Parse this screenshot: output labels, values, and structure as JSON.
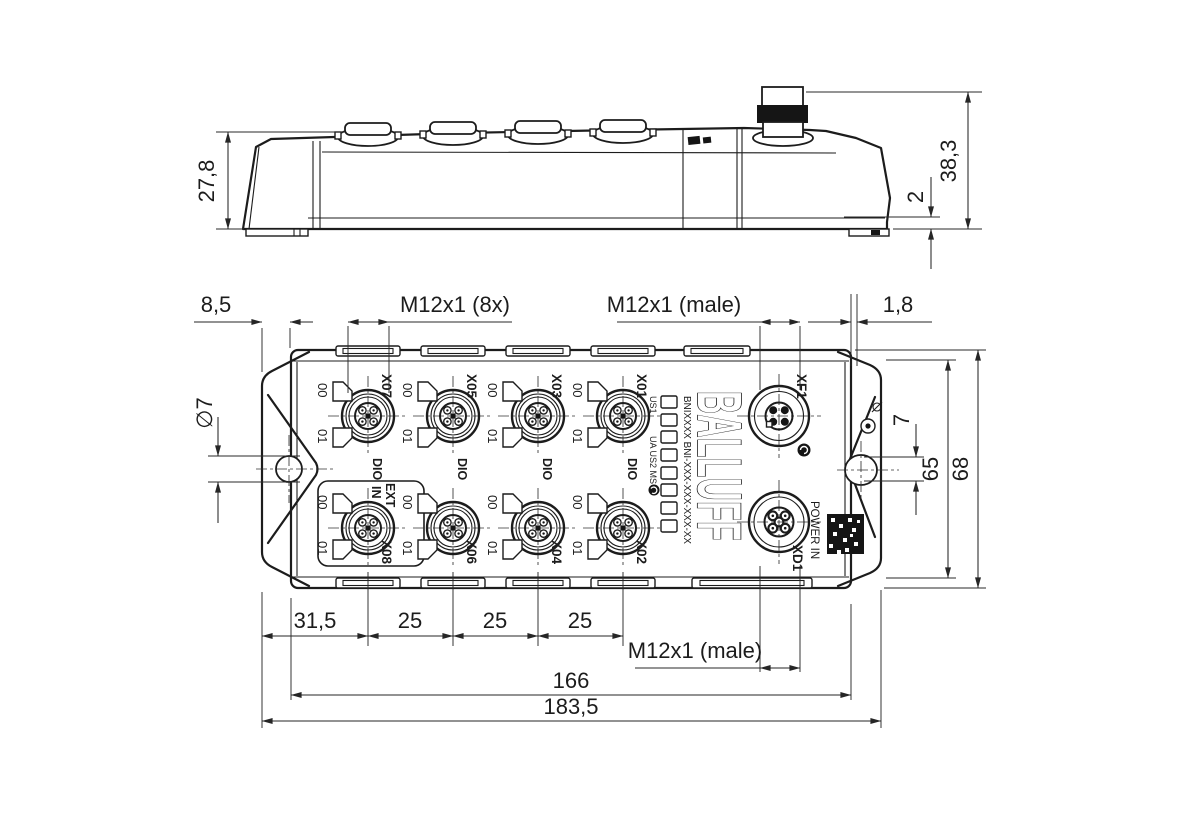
{
  "side_view": {
    "dim_height_left": "27,8",
    "dim_height_right": "38,3",
    "dim_foot_height": "2"
  },
  "top_view": {
    "dim_mount_offset": "8,5",
    "dim_hole_diameter": "∅7",
    "label_ports_thread": "M12x1 (8x)",
    "label_bus_thread": "M12x1 (male)",
    "dim_tab_thickness": "1,8",
    "dim_slot_width": "7",
    "dim_height_inner": "65",
    "dim_height_outer": "68",
    "dim_first_pitch": "31,5",
    "dim_port_pitch": "25",
    "label_power_thread": "M12x1 (male)",
    "dim_length_inner": "166",
    "dim_length_outer": "183,5",
    "brand": "BALLUFF",
    "part_number": "BNIXXXX  BNI-XXX-XXX-XXX-XX",
    "led_label_us1": "US1",
    "led_label_ua": "UA US2 MS",
    "label_power_in": "POWER IN",
    "label_dio": "DIO",
    "label_ext": "EXT",
    "label_in": "IN",
    "label_led_00": "00",
    "label_led_01": "01",
    "ports_top": [
      "X07",
      "X05",
      "X03",
      "X01"
    ],
    "ports_bottom": [
      "X08",
      "X06",
      "X04",
      "X02"
    ],
    "port_network": "XF1",
    "port_power": "XD1"
  }
}
